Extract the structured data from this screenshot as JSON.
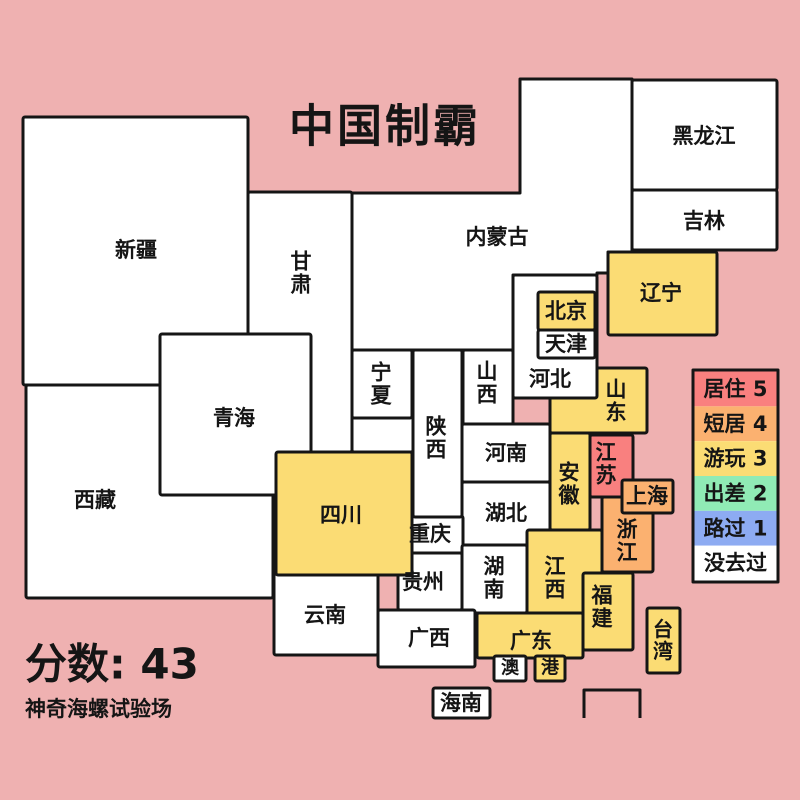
{
  "title": "中国制霸",
  "score": {
    "label": "分数: 43"
  },
  "footer": {
    "credit": "神奇海螺试验场"
  },
  "palette": {
    "background": "#efb1b1",
    "border": "#151515",
    "text": "#151515",
    "levels": {
      "0": "#ffffff",
      "1": "#8dabf2",
      "2": "#90ebb5",
      "3": "#fbdc74",
      "4": "#fbb170",
      "5": "#f9807f"
    }
  },
  "legend": {
    "x": 693,
    "y": 370,
    "w": 85,
    "h": 212,
    "items": [
      {
        "label": "居住 5",
        "level": 5
      },
      {
        "label": "短居 4",
        "level": 4
      },
      {
        "label": "游玩 3",
        "level": 3
      },
      {
        "label": "出差 2",
        "level": 2
      },
      {
        "label": "路过 1",
        "level": 1
      },
      {
        "label": "没去过",
        "level": 0
      }
    ]
  },
  "map": {
    "blank_area": {
      "x": 352,
      "y": 350,
      "w": 61,
      "h": 102
    },
    "sea_box": {
      "d": "M584,718 L584,690 L640,690 L640,718"
    },
    "provinces": [
      {
        "id": "xinjiang",
        "label": "新疆",
        "x": 23,
        "y": 117,
        "w": 225,
        "h": 268,
        "level": 0,
        "lx": 136,
        "ly": 250,
        "vertical": false
      },
      {
        "id": "tibet",
        "label": "西藏",
        "x": 26,
        "y": 385,
        "w": 247,
        "h": 213,
        "level": 0,
        "lx": 95,
        "ly": 500,
        "vertical": false
      },
      {
        "id": "gansu",
        "label": "甘肃",
        "x": 248,
        "y": 192,
        "w": 104,
        "h": 260,
        "level": 0,
        "lx": 301,
        "ly": 273,
        "vertical": true
      },
      {
        "id": "qinghai",
        "label": "青海",
        "x": 160,
        "y": 334,
        "w": 151,
        "h": 161,
        "level": 0,
        "lx": 234,
        "ly": 418,
        "vertical": false
      },
      {
        "id": "inner-mongolia",
        "label": "内蒙古",
        "poly": "M352,193 L520,193 L520,79 L632,79 L632,252 L608,252 L608,273 L597,273 L597,275 L513,275 L513,350 L352,350 Z",
        "level": 0,
        "lx": 497,
        "ly": 237,
        "vertical": false
      },
      {
        "id": "sichuan",
        "label": "四川",
        "x": 276,
        "y": 452,
        "w": 136,
        "h": 123,
        "level": 3,
        "lx": 341,
        "ly": 515,
        "vertical": false
      },
      {
        "id": "shaanxi",
        "label": "陕西",
        "x": 413,
        "y": 350,
        "w": 49,
        "h": 167,
        "level": 0,
        "lx": 436,
        "ly": 438,
        "vertical": true
      },
      {
        "id": "ningxia",
        "label": "宁夏",
        "x": 352,
        "y": 350,
        "w": 60,
        "h": 68,
        "level": 0,
        "lx": 381,
        "ly": 384,
        "vertical": true
      },
      {
        "id": "shanxi",
        "label": "山西",
        "x": 463,
        "y": 350,
        "w": 50,
        "h": 75,
        "level": 0,
        "lx": 487,
        "ly": 383,
        "vertical": true
      },
      {
        "id": "shandong",
        "label": "山东",
        "x": 550,
        "y": 368,
        "w": 97,
        "h": 65,
        "level": 3,
        "lx": 616,
        "ly": 401,
        "vertical": true
      },
      {
        "id": "hebei",
        "label": "河北",
        "x": 513,
        "y": 275,
        "w": 84,
        "h": 123,
        "level": 0,
        "lx": 550,
        "ly": 379,
        "vertical": false
      },
      {
        "id": "beijing",
        "label": "北京",
        "x": 538,
        "y": 292,
        "w": 57,
        "h": 38,
        "level": 3,
        "lx": 566,
        "ly": 311,
        "vertical": false
      },
      {
        "id": "tianjin",
        "label": "天津",
        "x": 538,
        "y": 330,
        "w": 57,
        "h": 28,
        "level": 0,
        "lx": 566,
        "ly": 344,
        "vertical": false
      },
      {
        "id": "henan",
        "label": "河南",
        "x": 462,
        "y": 424,
        "w": 88,
        "h": 58,
        "level": 0,
        "lx": 506,
        "ly": 453,
        "vertical": false
      },
      {
        "id": "anhui",
        "label": "安徽",
        "x": 550,
        "y": 433,
        "w": 40,
        "h": 97,
        "level": 3,
        "lx": 569,
        "ly": 484,
        "vertical": true
      },
      {
        "id": "jiangsu",
        "label": "江苏",
        "x": 590,
        "y": 435,
        "w": 43,
        "h": 62,
        "level": 5,
        "lx": 606,
        "ly": 464,
        "vertical": true
      },
      {
        "id": "hubei",
        "label": "湖北",
        "x": 462,
        "y": 482,
        "w": 88,
        "h": 63,
        "level": 0,
        "lx": 506,
        "ly": 513,
        "vertical": false
      },
      {
        "id": "chongqing",
        "label": "重庆",
        "x": 398,
        "y": 516,
        "w": 65,
        "h": 37,
        "level": 0,
        "lx": 430,
        "ly": 534,
        "vertical": false
      },
      {
        "id": "guizhou",
        "label": "贵州",
        "x": 398,
        "y": 553,
        "w": 64,
        "h": 57,
        "level": 0,
        "lx": 423,
        "ly": 582,
        "vertical": false
      },
      {
        "id": "hunan",
        "label": "湖南",
        "x": 462,
        "y": 545,
        "w": 65,
        "h": 68,
        "level": 0,
        "lx": 494,
        "ly": 578,
        "vertical": true
      },
      {
        "id": "jiangxi",
        "label": "江西",
        "x": 527,
        "y": 530,
        "w": 75,
        "h": 92,
        "level": 3,
        "lx": 555,
        "ly": 578,
        "vertical": true
      },
      {
        "id": "zhejiang",
        "label": "浙江",
        "x": 602,
        "y": 497,
        "w": 51,
        "h": 75,
        "level": 4,
        "lx": 627,
        "ly": 541,
        "vertical": true
      },
      {
        "id": "shanghai",
        "label": "上海",
        "x": 622,
        "y": 480,
        "w": 51,
        "h": 33,
        "level": 4,
        "lx": 647,
        "ly": 496,
        "vertical": false
      },
      {
        "id": "fujian",
        "label": "福建",
        "x": 583,
        "y": 573,
        "w": 50,
        "h": 77,
        "level": 3,
        "lx": 602,
        "ly": 607,
        "vertical": true
      },
      {
        "id": "yunnan",
        "label": "云南",
        "x": 274,
        "y": 574,
        "w": 104,
        "h": 81,
        "level": 0,
        "lx": 325,
        "ly": 615,
        "vertical": false
      },
      {
        "id": "guangxi",
        "label": "广西",
        "x": 378,
        "y": 610,
        "w": 97,
        "h": 57,
        "level": 0,
        "lx": 429,
        "ly": 638,
        "vertical": false
      },
      {
        "id": "guangdong",
        "label": "广东",
        "x": 477,
        "y": 613,
        "w": 106,
        "h": 45,
        "level": 3,
        "lx": 531,
        "ly": 641,
        "vertical": false
      },
      {
        "id": "macau",
        "label": "澳",
        "x": 494,
        "y": 656,
        "w": 32,
        "h": 25,
        "level": 0,
        "lx": 510,
        "ly": 668,
        "vertical": false,
        "fs": 18
      },
      {
        "id": "hongkong",
        "label": "港",
        "x": 535,
        "y": 656,
        "w": 30,
        "h": 25,
        "level": 3,
        "lx": 550,
        "ly": 668,
        "vertical": false,
        "fs": 18
      },
      {
        "id": "hainan",
        "label": "海南",
        "x": 433,
        "y": 688,
        "w": 57,
        "h": 30,
        "level": 0,
        "lx": 461,
        "ly": 703,
        "vertical": false
      },
      {
        "id": "taiwan",
        "label": "台湾",
        "x": 647,
        "y": 608,
        "w": 33,
        "h": 65,
        "level": 3,
        "lx": 663,
        "ly": 640,
        "vertical": true,
        "fs": 20
      },
      {
        "id": "heilongjiang",
        "label": "黑龙江",
        "x": 632,
        "y": 80,
        "w": 145,
        "h": 110,
        "level": 0,
        "lx": 704,
        "ly": 136,
        "vertical": false
      },
      {
        "id": "jilin",
        "label": "吉林",
        "x": 632,
        "y": 190,
        "w": 145,
        "h": 60,
        "level": 0,
        "lx": 704,
        "ly": 221,
        "vertical": false
      },
      {
        "id": "liaoning",
        "label": "辽宁",
        "x": 608,
        "y": 252,
        "w": 109,
        "h": 83,
        "level": 3,
        "lx": 661,
        "ly": 293,
        "vertical": false
      }
    ]
  }
}
